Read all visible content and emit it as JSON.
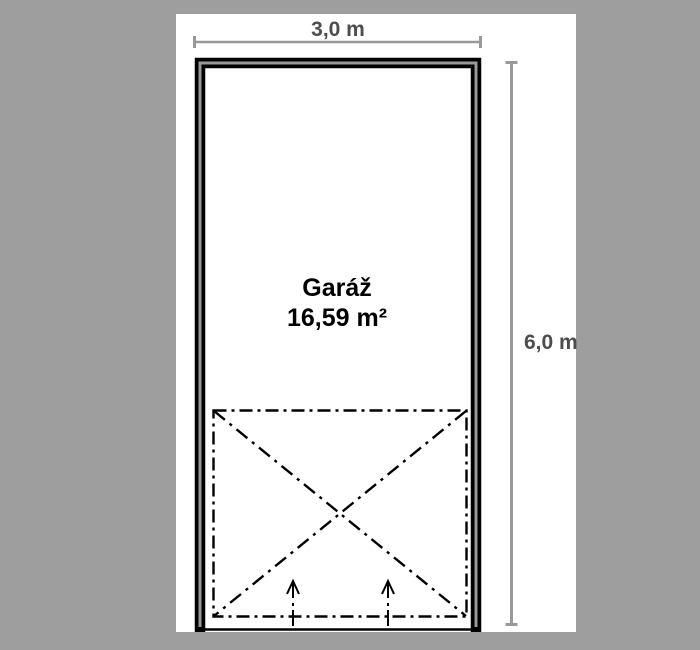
{
  "plan": {
    "room_label": "Garáž",
    "room_area": "16,59 m²",
    "width_dim": "3,0 m",
    "height_dim": "6,0 m"
  },
  "colors": {
    "background": "#9e9e9e",
    "paper": "#ffffff",
    "wall_outline": "#000000",
    "wall_core": "#999999",
    "dimension_line": "#999999",
    "dimension_text": "#4d4d4d",
    "drawing_line": "#000000",
    "room_text": "#000000"
  },
  "icons": {
    "door_arrows": "up-arrow"
  }
}
